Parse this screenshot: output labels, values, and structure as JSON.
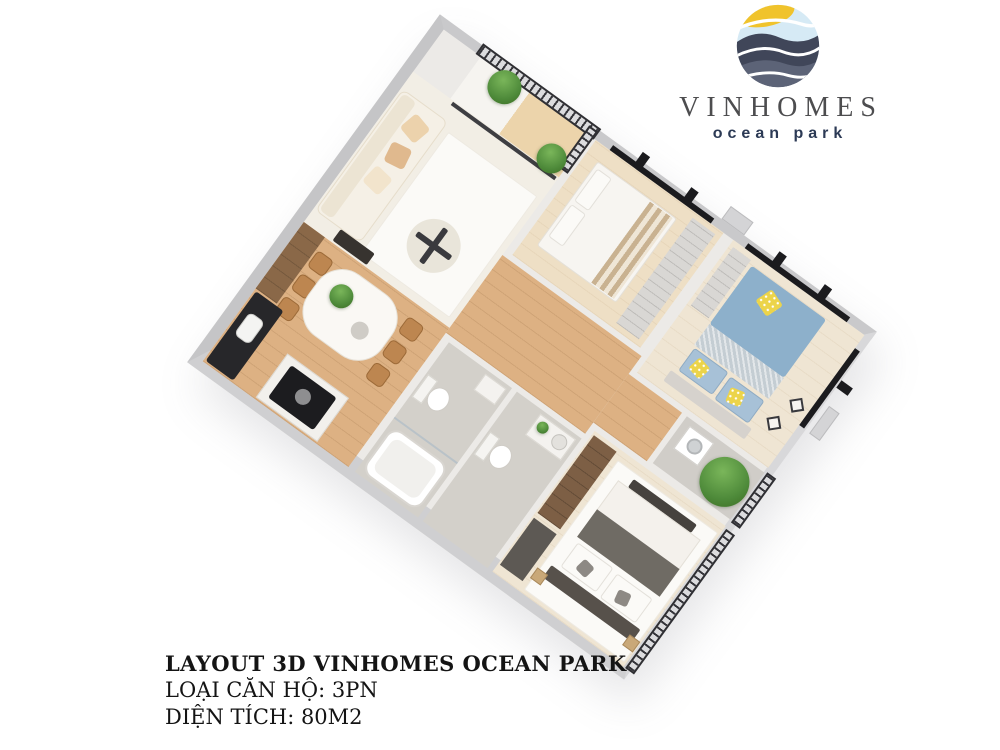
{
  "logo": {
    "name": "VINHOMES",
    "subtitle": "ocean park",
    "colors": {
      "sun_yellow": "#f0c32c",
      "sky_blue": "#d6eaf5",
      "wave_navy": "#404659",
      "wave_slate": "#5c6377",
      "name_gray": "#4d4d4f",
      "subtitle_navy": "#2c3a55"
    }
  },
  "caption": {
    "line1": "LAYOUT 3D VINHOMES OCEAN PARK",
    "line2": "LOẠI CĂN HỘ: 3PN",
    "line3": "DIỆN TÍCH: 80M2"
  },
  "floorplan": {
    "rotation_deg": 36,
    "colors": {
      "outer_wall_gray": "#c9c9cb",
      "inner_wall": "#eceae7",
      "wood_floor": "#ddb183",
      "tile_floor": "#d3d0ca",
      "bed_blue": "#8db0cb",
      "accent_yellow": "#ecd44a",
      "plant_green": "#4e8a3a",
      "railing_dark": "#35353a",
      "window_frame_black": "#1b1b1e"
    }
  }
}
